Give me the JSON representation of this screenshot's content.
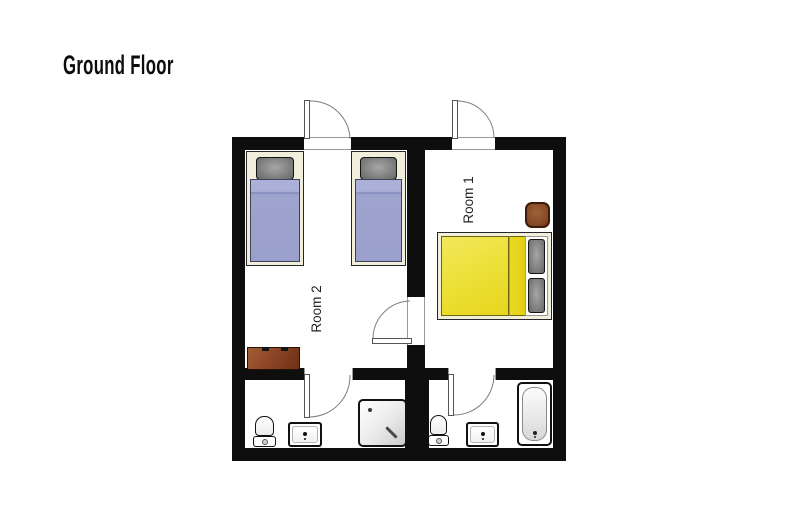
{
  "title": "Ground Floor",
  "rooms": {
    "room1": {
      "label": "Room 1"
    },
    "room2": {
      "label": "Room 2"
    }
  },
  "colors": {
    "wall": "#0e0e0e",
    "bed_frame": "#f1eedc",
    "twin_bed_duvet_blue": "#9ea4ce",
    "double_bed_duvet_yellow": "#ecdf33",
    "pillow_gray": "#8a8a8a",
    "wood_brown": "#8a4426",
    "door_arc_gray": "#7d7d7d",
    "fixture_outline": "#111111"
  },
  "furniture": {
    "room2": [
      "twin-bed",
      "twin-bed",
      "sideboard"
    ],
    "room1": [
      "double-bed",
      "stool"
    ],
    "left_bathroom": [
      "toilet",
      "sink",
      "shower"
    ],
    "right_bathroom": [
      "toilet",
      "sink",
      "bathtub"
    ]
  }
}
